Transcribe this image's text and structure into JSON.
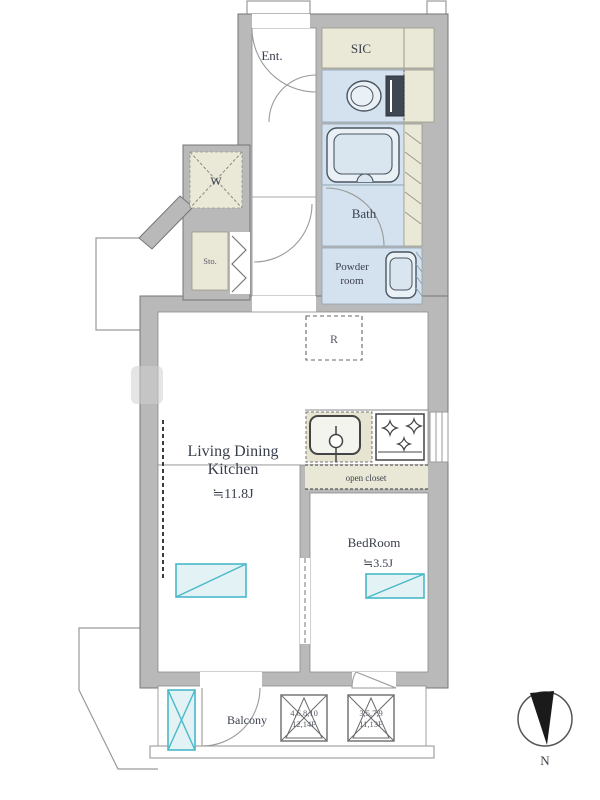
{
  "rooms": {
    "entrance": {
      "label": "Ent."
    },
    "sic": {
      "label": "SIC"
    },
    "bath": {
      "label": "Bath"
    },
    "powder_room": {
      "line1": "Powder",
      "line2": "room"
    },
    "washer": {
      "label": "W"
    },
    "storage": {
      "label": "Sto."
    },
    "refrigerator": {
      "label": "R"
    },
    "ldk": {
      "line1": "Living Dining",
      "line2": "Kitchen",
      "area": "≒11.8J"
    },
    "bedroom": {
      "label": "BedRoom",
      "area": "≒3.5J"
    },
    "open_closet": {
      "label": "open closet"
    },
    "balcony": {
      "label": "Balcony"
    }
  },
  "evacuation_hatches": [
    {
      "line1": "4,6,8,10",
      "line2": "12,14F"
    },
    {
      "line1": "3,5,7,9",
      "line2": "11,13F"
    }
  ],
  "compass": {
    "label": "N"
  },
  "colors": {
    "wall": "#b9b9b9",
    "wall_outline": "#757575",
    "room_blue": "#d3e2ee",
    "room_beige": "#eae8d6",
    "window_cyan": "#49b8c8",
    "text": "#3a3f4c"
  }
}
